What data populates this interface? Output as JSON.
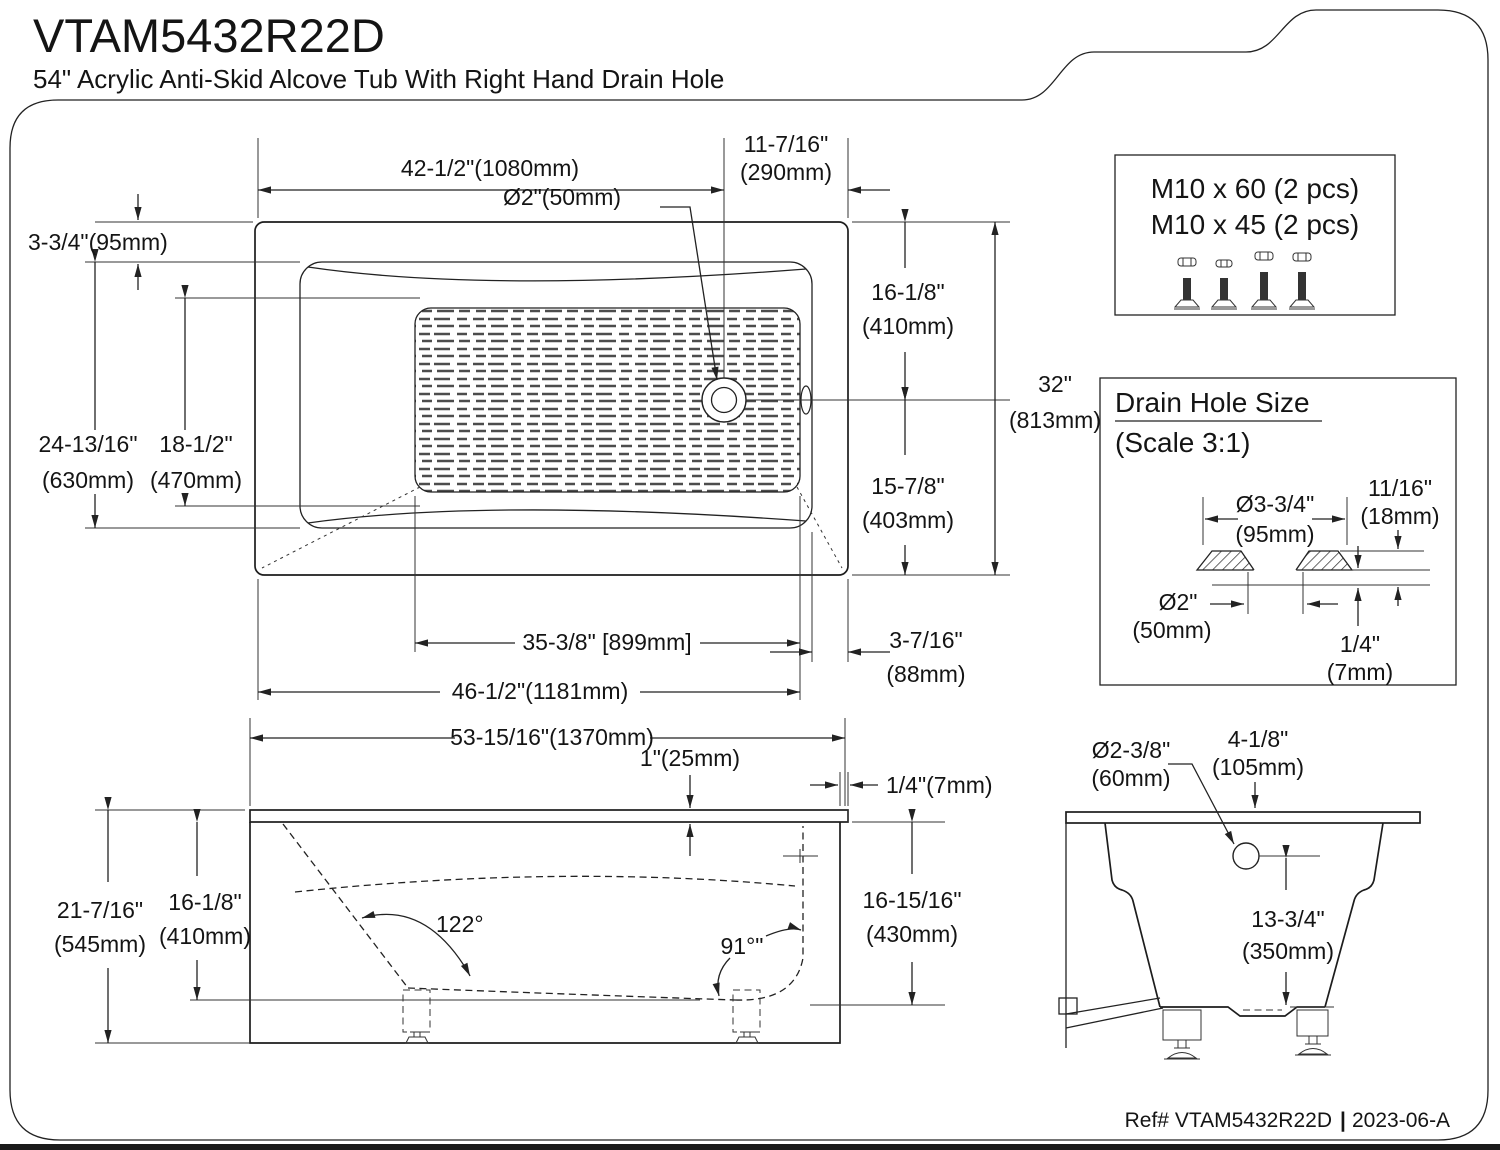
{
  "header": {
    "title": "VTAM5432R22D",
    "subtitle": "54\" Acrylic Anti-Skid Alcove Tub With Right Hand Drain Hole"
  },
  "footer": {
    "ref_label": "Ref# VTAM5432R22D",
    "separator": "|",
    "revision": "2023-06-A"
  },
  "hardware_box": {
    "line1": "M10 x 60 (2 pcs)",
    "line2": "M10 x 45 (2 pcs)"
  },
  "drain_detail": {
    "title": "Drain Hole Size",
    "scale_note": "(Scale 3:1)",
    "flange_diameter_in": "Ø3-3/4\"",
    "flange_diameter_mm": "(95mm)",
    "flange_height_in": "11/16\"",
    "flange_height_mm": "(18mm)",
    "hole_diameter_in": "Ø2\"",
    "hole_diameter_mm": "(50mm)",
    "lip_thickness_in": "1/4\"",
    "lip_thickness_mm": "(7mm)"
  },
  "top_view": {
    "drain_offset_left": "42-1/2\"(1080mm)",
    "drain_offset_right_in": "11-7/16\"",
    "drain_offset_right_mm": "(290mm)",
    "drain_diameter": "Ø2\"(50mm)",
    "deck_width": "3-3/4\"(95mm)",
    "inner_width_in": "24-13/16\"",
    "inner_width_mm": "(630mm)",
    "floor_width_in": "18-1/2\"",
    "floor_width_mm": "(470mm)",
    "drain_from_back_in": "16-1/8\"",
    "drain_from_back_mm": "(410mm)",
    "overall_width_in": "32\"",
    "overall_width_mm": "(813mm)",
    "drain_from_front_in": "15-7/8\"",
    "drain_from_front_mm": "(403mm)",
    "floor_length": "35-3/8\" [899mm]",
    "inner_length": "46-1/2\"(1181mm)",
    "end_deck_in": "3-7/16\"",
    "end_deck_mm": "(88mm)"
  },
  "side_view": {
    "overall_length": "53-15/16\"(1370mm)",
    "rim_thickness": "1\"(25mm)",
    "rim_overhang": "1/4\"(7mm)",
    "overall_height_in": "21-7/16\"",
    "overall_height_mm": "(545mm)",
    "inner_depth_in": "16-1/8\"",
    "inner_depth_mm": "(410mm)",
    "back_angle": "122°",
    "front_angle": "91°\"",
    "skirt_height_in": "16-15/16\"",
    "skirt_height_mm": "(430mm)"
  },
  "end_view": {
    "drain_hole_diameter_in": "Ø2-3/8\"",
    "drain_hole_diameter_mm": "(60mm)",
    "drain_offset_in": "4-1/8\"",
    "drain_offset_mm": "(105mm)",
    "drain_height_in": "13-3/4\"",
    "drain_height_mm": "(350mm)"
  }
}
